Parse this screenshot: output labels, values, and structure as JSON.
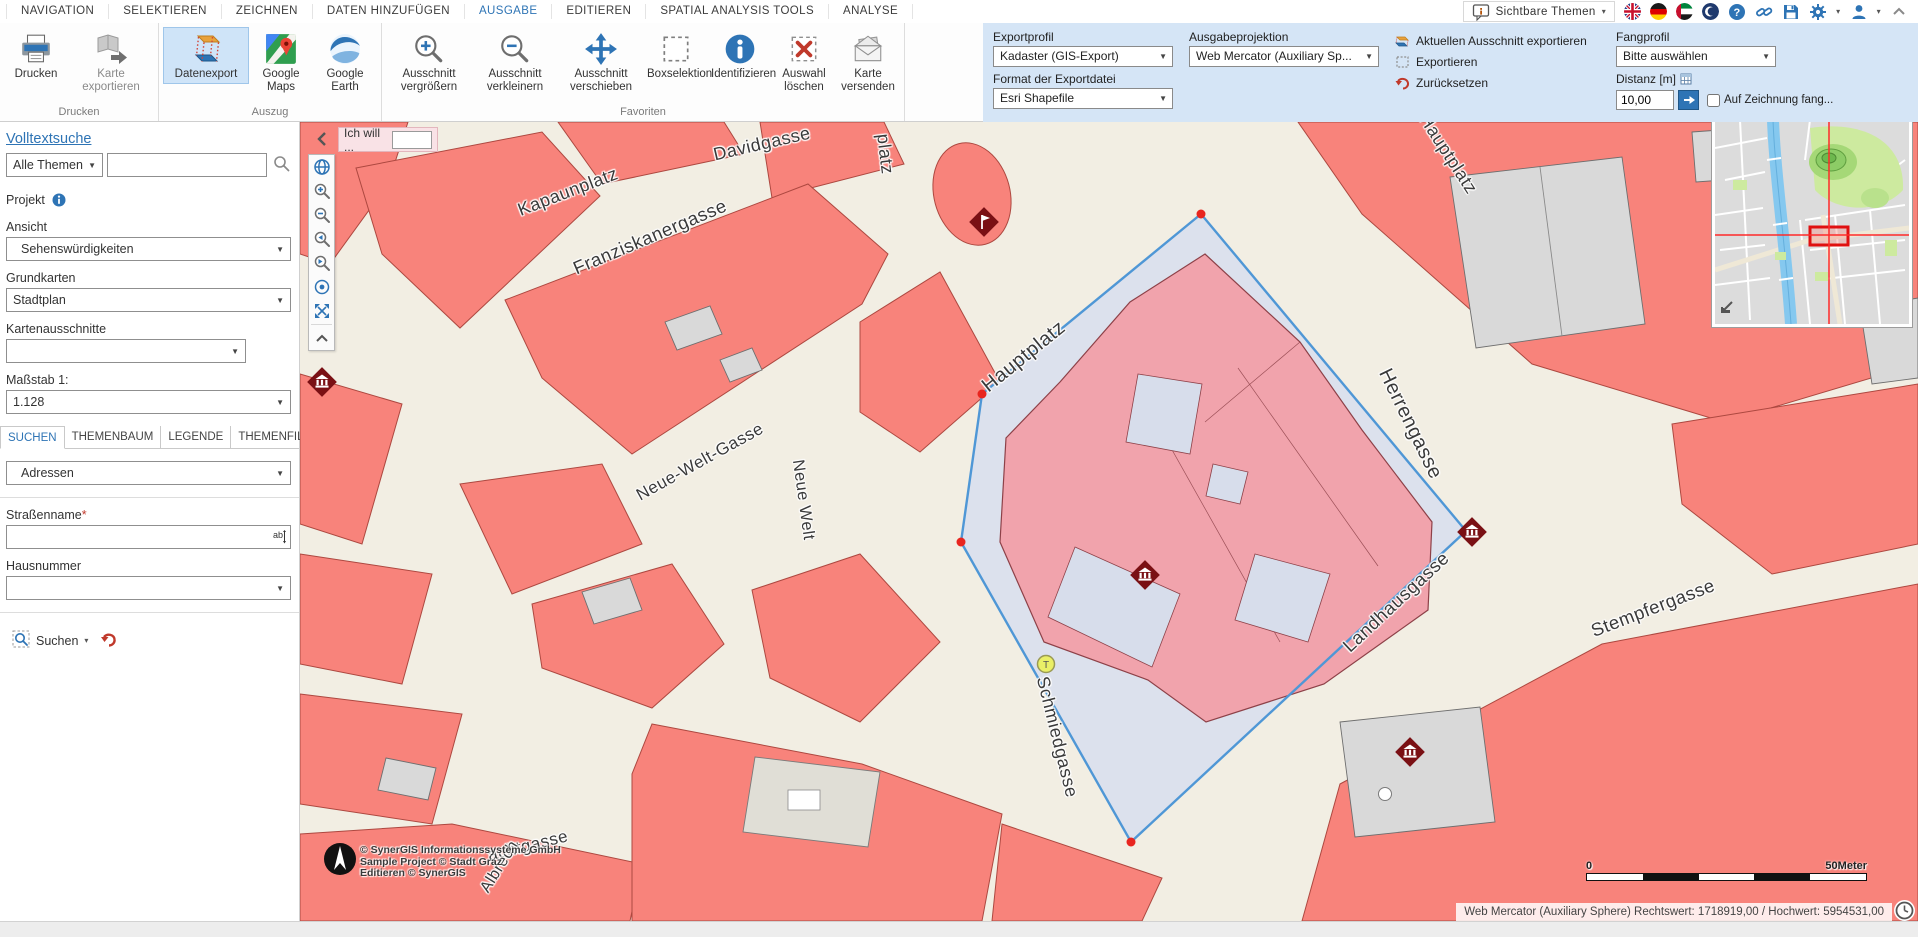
{
  "menu": {
    "items": [
      {
        "label": "NAVIGATION"
      },
      {
        "label": "SELEKTIEREN"
      },
      {
        "label": "ZEICHNEN"
      },
      {
        "label": "DATEN HINZUFÜGEN"
      },
      {
        "label": "AUSGABE",
        "active": true
      },
      {
        "label": "EDITIEREN"
      },
      {
        "label": "SPATIAL ANALYSIS TOOLS"
      },
      {
        "label": "ANALYSE"
      }
    ],
    "right_label": "Sichtbare Themen",
    "window_icons": [
      "visible-themes-bubble",
      "flag-uk",
      "flag-de",
      "flag-uae",
      "flag-crescent",
      "help",
      "link",
      "save",
      "settings-gear",
      "user",
      "collapse-up"
    ]
  },
  "ribbon": {
    "groups": [
      {
        "label": "Drucken",
        "buttons": [
          {
            "label": "Drucken"
          },
          {
            "label": "Karte exportieren",
            "disabled": true
          }
        ]
      },
      {
        "label": "Auszug",
        "buttons": [
          {
            "label": "Datenexport",
            "active": true
          },
          {
            "label": "Google Maps"
          },
          {
            "label": "Google Earth"
          }
        ]
      },
      {
        "label": "Favoriten",
        "buttons": [
          {
            "label": "Ausschnitt vergrößern"
          },
          {
            "label": "Ausschnitt verkleinern"
          },
          {
            "label": "Ausschnitt verschieben"
          },
          {
            "label": "Boxselektion"
          },
          {
            "label": "Identifizieren"
          },
          {
            "label": "Auswahl löschen"
          },
          {
            "label": "Karte versenden"
          }
        ]
      }
    ],
    "export_panel": {
      "exportprofil_label": "Exportprofil",
      "exportprofil_value": "Kadaster (GIS-Export)",
      "format_label": "Format der Exportdatei",
      "format_value": "Esri Shapefile",
      "projektion_label": "Ausgabeprojektion",
      "projektion_value": "Web Mercator (Auxiliary Sp...",
      "actions": [
        {
          "label": "Aktuellen Ausschnitt exportieren"
        },
        {
          "label": "Exportieren"
        },
        {
          "label": "Zurücksetzen"
        }
      ],
      "fangprofil_label": "Fangprofil",
      "fangprofil_value": "Bitte auswählen",
      "distanz_label": "Distanz [m]",
      "distanz_value": "10,00",
      "fang_checkbox_label": "Auf Zeichnung fang..."
    }
  },
  "sidebar": {
    "volltextsuche_label": "Volltextsuche",
    "themen_value": "Alle Themen",
    "search_value": "",
    "projekt_label": "Projekt",
    "ansicht_label": "Ansicht",
    "ansicht_value": "Sehenswürdigkeiten",
    "grundkarten_label": "Grundkarten",
    "grundkarten_value": "Stadtplan",
    "kartenausschnitte_label": "Kartenausschnitte",
    "kartenausschnitte_value": "",
    "massstab_label": "Maßstab 1:",
    "massstab_value": "1.128",
    "tabs": [
      {
        "label": "SUCHEN",
        "active": true
      },
      {
        "label": "THEMENBAUM"
      },
      {
        "label": "LEGENDE"
      },
      {
        "label": "THEMENFILTER"
      }
    ],
    "adressen_value": "Adressen",
    "strassenname_label": "Straßenname",
    "required_mark": "*",
    "hausnummer_label": "Hausnummer",
    "suchen_button": "Suchen"
  },
  "map": {
    "ich_will_label": "Ich will ...",
    "street_labels": [
      {
        "name": "ergasse"
      },
      {
        "name": "Kapaunplatz"
      },
      {
        "name": "Davidgasse"
      },
      {
        "name": "Franziskanergasse"
      },
      {
        "name": "platz"
      },
      {
        "name": "Hauptplatz"
      },
      {
        "name": "Hauptplatz"
      },
      {
        "name": "Neue-Welt-Gasse"
      },
      {
        "name": "Neue Welt"
      },
      {
        "name": "Herrengasse"
      },
      {
        "name": "Landhausgasse"
      },
      {
        "name": "Schmiedgasse"
      },
      {
        "name": "Stempfergasse"
      },
      {
        "name": "achtgasse"
      },
      {
        "name": "Albrech"
      }
    ],
    "tram_label": "T",
    "copyright": {
      "line1": "© SynerGIS Informationssysteme GmbH",
      "line2": "Sample Project © Stadt Graz",
      "line3": "Editieren © SynerGIS"
    },
    "scale": {
      "start": "0",
      "end": "50Meter"
    },
    "status_text": "Web Mercator (Auxiliary Sphere) Rechtswert: 1718919,00 / Hochwert: 5954531,00",
    "colors": {
      "accent_blue": "#2e74b5",
      "selection_line": "#4f97d6",
      "selection_fill": "#dce1ed",
      "block_salmon": "#f8837b",
      "highlight_pink": "#f1a3ac",
      "street_beige": "#f2eee3",
      "marker_dark_red": "#7a1014",
      "vertex_red": "#e8251f"
    }
  }
}
